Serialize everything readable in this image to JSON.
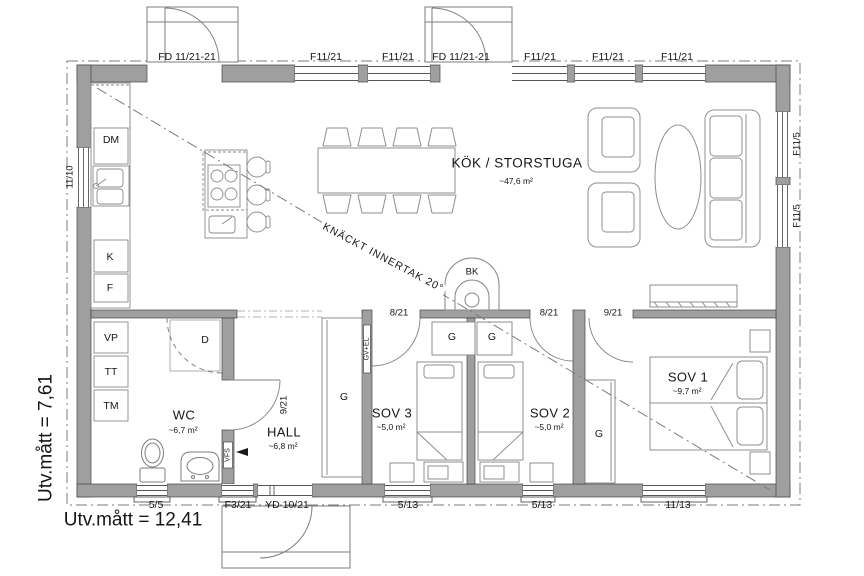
{
  "rooms": {
    "kok": {
      "name": "KÖK / STORSTUGA",
      "area": "~47,6 m²"
    },
    "wc": {
      "name": "WC",
      "area": "~6,7 m²"
    },
    "hall": {
      "name": "HALL",
      "area": "~6,8 m²"
    },
    "sov3": {
      "name": "SOV 3",
      "area": "~5,0 m²"
    },
    "sov2": {
      "name": "SOV 2",
      "area": "~5,0 m²"
    },
    "sov1": {
      "name": "SOV 1",
      "area": "~9,7 m²"
    }
  },
  "openings": {
    "fd_door": "FD 11/21-21",
    "window_f1121": "F11/21",
    "window_f115": "F11/5",
    "window_1110": "11/10",
    "window_55": "5/5",
    "window_f321": "F3/21",
    "door_yd": "YD 10/21",
    "window_513": "5/13",
    "window_1113": "11/13",
    "door_821": "8/21",
    "door_921": "9/21"
  },
  "fixtures": {
    "dm": "DM",
    "kyl": "K",
    "frys": "F",
    "vp": "VP",
    "tt": "TT",
    "tm": "TM",
    "shower": "D",
    "fireplace": "BK",
    "wardrobe": "G",
    "vfs": "VFS",
    "gv_el": "GV+EL"
  },
  "annotations": {
    "ceiling_note": "KNÄCKT INNERTAK 20°",
    "ext_width": "Utv.mått = 12,41",
    "ext_height": "Utv.mått = 7,61"
  }
}
